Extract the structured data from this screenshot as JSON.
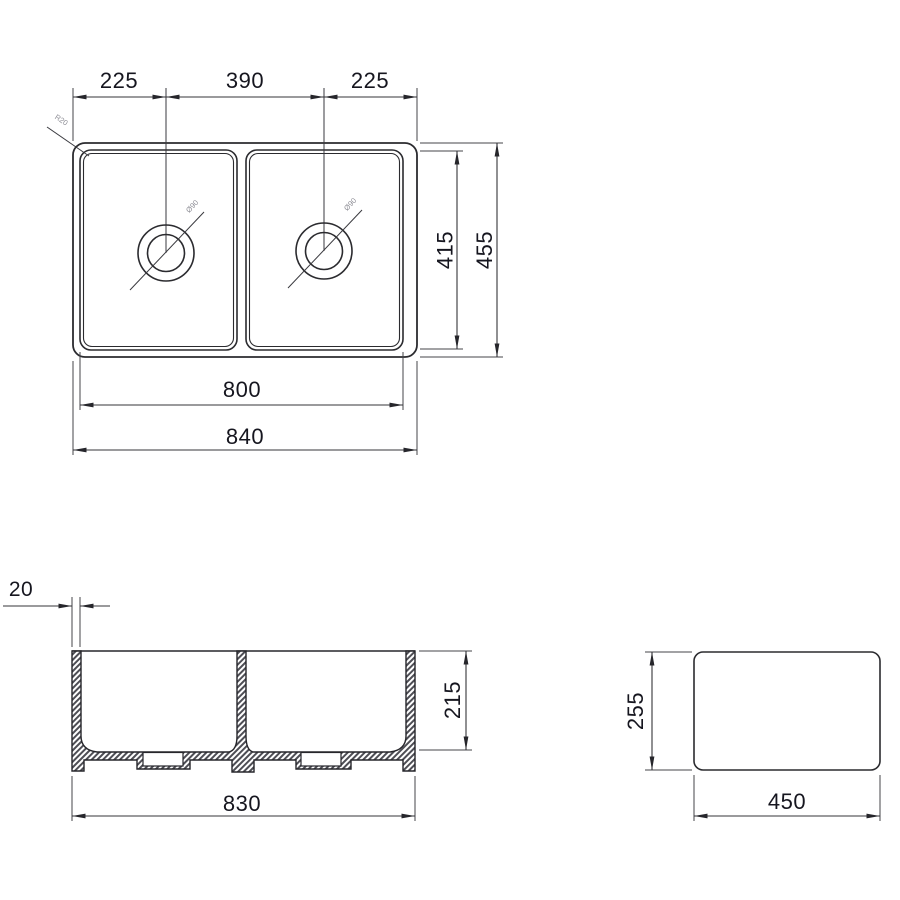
{
  "drawing": {
    "top_view": {
      "dim_left_drain_offset": "225",
      "dim_drain_spacing": "390",
      "dim_right_drain_offset": "225",
      "dim_inner_depth": "415",
      "dim_outer_depth": "455",
      "dim_inner_width": "800",
      "dim_outer_width": "840",
      "corner_radius_label": "R20",
      "drain_diameter_label": "Ø90"
    },
    "front_section_view": {
      "dim_wall_thickness": "20",
      "dim_bowl_depth": "215",
      "dim_base_width": "830"
    },
    "side_view": {
      "dim_height": "255",
      "dim_width": "450"
    },
    "colors": {
      "line": "#2b2b2f",
      "text": "#16161f",
      "hatch": "#4e4e55",
      "background": "#ffffff"
    }
  }
}
